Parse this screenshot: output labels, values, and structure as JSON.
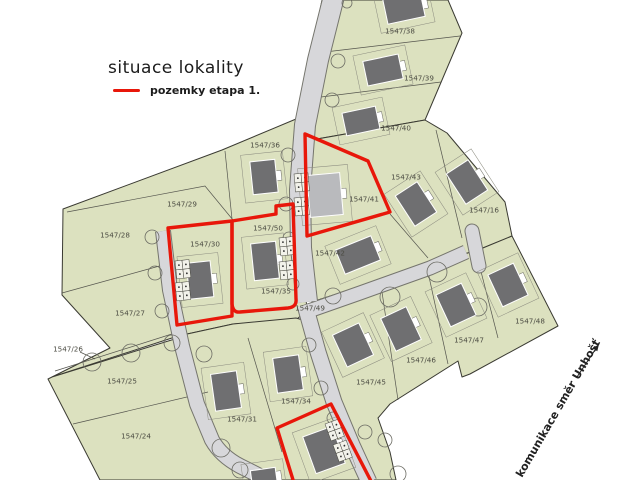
{
  "title": "situace lokality",
  "legend": {
    "label": "pozemky etapa 1.",
    "swatch_color": "#e8170a"
  },
  "road_direction": {
    "label": "komunikace směr Unhošť"
  },
  "colors": {
    "background": "#ffffff",
    "parcel": "#dce1bf",
    "outline": "#3a3a32",
    "inner_line": "#55554e",
    "road": "#d7d7da",
    "road_edge": "#75756d",
    "house": "#6f6f71",
    "house_light": "#b9babd",
    "envelope": "#8b8b7f",
    "tree": "#6c6c64",
    "red": "#e8170a",
    "label": "#4b4b42"
  },
  "map": {
    "blocks": [
      {
        "name": "west",
        "points": "63,209 222,150 296,119 300,150 301,245 307,310 296,320 233,324 178,336 52,377 110,348 62,295"
      },
      {
        "name": "southwest",
        "points": "52,377 178,338 190,395 205,435 222,458 240,470 254,480 100,480 48,379"
      },
      {
        "name": "south-middle",
        "points": "178,336 233,324 296,318 310,322 340,402 362,465 368,480 250,480 232,462 205,430 190,390"
      },
      {
        "name": "north-strip",
        "points": "322,0 448,0 462,33 425,120 300,142 304,95 313,45"
      },
      {
        "name": "east-middle",
        "points": "300,142 425,120 447,133 505,202 512,236 478,250 430,264 312,302 303,250 300,190"
      },
      {
        "name": "southeast",
        "points": "312,302 430,264 478,250 512,236 558,326 470,374 462,377 458,361 390,404 378,418 390,452 396,480 368,480 352,440 335,395 318,330"
      }
    ],
    "roads": [
      {
        "name": "road-north",
        "d": "M334,-4 L318,60 L305,125 L300,190 L301,248 L307,302",
        "width": 20
      },
      {
        "name": "road-east",
        "d": "M303,313 L360,293 L430,268 L466,252",
        "width": 13
      },
      {
        "name": "road-turnaround",
        "d": "M472,231 L479,266",
        "width": 13
      },
      {
        "name": "road-south",
        "d": "M305,305 L318,352 L334,402 L352,445 L369,482",
        "width": 15
      },
      {
        "name": "road-west",
        "d": "M163,231 L170,290 L182,346 L197,404 L212,440 Q221,456 240,466 L260,476",
        "width": 14
      }
    ],
    "boundaries": [
      {
        "points": "67,212 205,186 233,220"
      },
      {
        "points": "62,293 163,265"
      },
      {
        "points": "225,151 232,219"
      },
      {
        "points": "325,52 460,36"
      },
      {
        "points": "313,98 441,82"
      },
      {
        "points": "436,130 462,238"
      },
      {
        "points": "390,214 428,258"
      },
      {
        "points": "382,292 398,400"
      },
      {
        "points": "428,272 448,364"
      },
      {
        "points": "476,252 498,338"
      },
      {
        "points": "248,338 282,452"
      },
      {
        "points": "73,424 208,392"
      },
      {
        "points": "55,371 175,333"
      },
      {
        "points": "80,352 95,359"
      }
    ],
    "red_outlines": [
      {
        "name": "etapa1-parcel-41",
        "d": "M305,134 L368,161 L390,212 L307,236 Z"
      },
      {
        "name": "etapa1-parcel-30",
        "d": "M168,228 L232,221 L232,316 L177,325 Z"
      },
      {
        "name": "etapa1-parcel-50-35",
        "d": "M232,221 L276,214 L276,206 L293,204 L296,299 Q297,307 288,308 L240,312 Q233,313 232,304 Z"
      },
      {
        "name": "etapa1-parcel-south",
        "d": "M294,483 L277,428 L331,404 L372,483"
      }
    ],
    "houses": [
      {
        "cx": 404,
        "cy": 8,
        "w": 38,
        "h": 25,
        "rot": -12,
        "shade": "dark"
      },
      {
        "cx": 383,
        "cy": 70,
        "w": 36,
        "h": 25,
        "rot": -12,
        "shade": "dark"
      },
      {
        "cx": 361,
        "cy": 121,
        "w": 34,
        "h": 23,
        "rot": -12,
        "shade": "dark"
      },
      {
        "cx": 264,
        "cy": 177,
        "w": 25,
        "h": 33,
        "rot": -6,
        "shade": "dark"
      },
      {
        "cx": 325,
        "cy": 195,
        "w": 33,
        "h": 42,
        "rot": -5,
        "shade": "light"
      },
      {
        "cx": 416,
        "cy": 204,
        "w": 26,
        "h": 36,
        "rot": -33,
        "shade": "dark"
      },
      {
        "cx": 467,
        "cy": 182,
        "w": 26,
        "h": 36,
        "rot": -33,
        "shade": "dark"
      },
      {
        "cx": 358,
        "cy": 255,
        "w": 38,
        "h": 26,
        "rot": -22,
        "shade": "dark"
      },
      {
        "cx": 200,
        "cy": 280,
        "w": 24,
        "h": 36,
        "rot": -6,
        "shade": "dark"
      },
      {
        "cx": 265,
        "cy": 261,
        "w": 25,
        "h": 37,
        "rot": -6,
        "shade": "dark"
      },
      {
        "cx": 226,
        "cy": 391,
        "w": 26,
        "h": 37,
        "rot": -8,
        "shade": "dark"
      },
      {
        "cx": 288,
        "cy": 374,
        "w": 26,
        "h": 35,
        "rot": -8,
        "shade": "dark"
      },
      {
        "cx": 353,
        "cy": 345,
        "w": 29,
        "h": 35,
        "rot": -25,
        "shade": "dark"
      },
      {
        "cx": 401,
        "cy": 329,
        "w": 28,
        "h": 36,
        "rot": -25,
        "shade": "dark"
      },
      {
        "cx": 456,
        "cy": 305,
        "w": 28,
        "h": 35,
        "rot": -25,
        "shade": "dark"
      },
      {
        "cx": 508,
        "cy": 285,
        "w": 28,
        "h": 35,
        "rot": -25,
        "shade": "dark"
      },
      {
        "cx": 324,
        "cy": 450,
        "w": 31,
        "h": 39,
        "rot": -20,
        "shade": "dark"
      },
      {
        "cx": 264,
        "cy": 478,
        "w": 25,
        "h": 18,
        "rot": -8,
        "shade": "dark"
      }
    ],
    "garages": [
      {
        "x": 294,
        "y": 174,
        "rot": -5
      },
      {
        "x": 294,
        "y": 198,
        "rot": -5
      },
      {
        "x": 175,
        "y": 261,
        "rot": -6
      },
      {
        "x": 175,
        "y": 283,
        "rot": -6
      },
      {
        "x": 279,
        "y": 238,
        "rot": -6
      },
      {
        "x": 279,
        "y": 262,
        "rot": -6
      },
      {
        "x": 325,
        "y": 424,
        "rot": -20
      },
      {
        "x": 333,
        "y": 445,
        "rot": -20
      }
    ],
    "trees": [
      {
        "cx": 152,
        "cy": 237,
        "r": 7
      },
      {
        "cx": 155,
        "cy": 273,
        "r": 7
      },
      {
        "cx": 162,
        "cy": 311,
        "r": 7
      },
      {
        "cx": 92,
        "cy": 362,
        "r": 9
      },
      {
        "cx": 131,
        "cy": 353,
        "r": 9
      },
      {
        "cx": 172,
        "cy": 343,
        "r": 8
      },
      {
        "cx": 204,
        "cy": 354,
        "r": 8
      },
      {
        "cx": 221,
        "cy": 448,
        "r": 9
      },
      {
        "cx": 240,
        "cy": 470,
        "r": 8
      },
      {
        "cx": 288,
        "cy": 155,
        "r": 7
      },
      {
        "cx": 286,
        "cy": 204,
        "r": 7
      },
      {
        "cx": 289,
        "cy": 238,
        "r": 6
      },
      {
        "cx": 293,
        "cy": 284,
        "r": 6
      },
      {
        "cx": 338,
        "cy": 61,
        "r": 7
      },
      {
        "cx": 332,
        "cy": 100,
        "r": 7
      },
      {
        "cx": 347,
        "cy": 3,
        "r": 5
      },
      {
        "cx": 333,
        "cy": 296,
        "r": 8
      },
      {
        "cx": 390,
        "cy": 297,
        "r": 10
      },
      {
        "cx": 437,
        "cy": 272,
        "r": 10
      },
      {
        "cx": 478,
        "cy": 307,
        "r": 9
      },
      {
        "cx": 309,
        "cy": 345,
        "r": 7
      },
      {
        "cx": 321,
        "cy": 388,
        "r": 7
      },
      {
        "cx": 333,
        "cy": 418,
        "r": 6
      },
      {
        "cx": 365,
        "cy": 432,
        "r": 7
      },
      {
        "cx": 385,
        "cy": 440,
        "r": 7
      },
      {
        "cx": 398,
        "cy": 474,
        "r": 8
      }
    ],
    "parcels": [
      {
        "label": "1547/38",
        "x": 400,
        "y": 31
      },
      {
        "label": "1547/39",
        "x": 419,
        "y": 78
      },
      {
        "label": "1547/40",
        "x": 396,
        "y": 128
      },
      {
        "label": "1547/36",
        "x": 265,
        "y": 145
      },
      {
        "label": "1547/43",
        "x": 406,
        "y": 177
      },
      {
        "label": "1547/41",
        "x": 364,
        "y": 199
      },
      {
        "label": "1547/16",
        "x": 484,
        "y": 210
      },
      {
        "label": "1547/29",
        "x": 182,
        "y": 204
      },
      {
        "label": "1547/28",
        "x": 115,
        "y": 235
      },
      {
        "label": "1547/30",
        "x": 205,
        "y": 244
      },
      {
        "label": "1547/50",
        "x": 268,
        "y": 228
      },
      {
        "label": "1547/42",
        "x": 330,
        "y": 253
      },
      {
        "label": "1547/35",
        "x": 276,
        "y": 291
      },
      {
        "label": "1547/49",
        "x": 310,
        "y": 308
      },
      {
        "label": "1547/27",
        "x": 130,
        "y": 313
      },
      {
        "label": "1547/26",
        "x": 68,
        "y": 349
      },
      {
        "label": "1547/25",
        "x": 122,
        "y": 381
      },
      {
        "label": "1547/24",
        "x": 136,
        "y": 436
      },
      {
        "label": "1547/31",
        "x": 242,
        "y": 419
      },
      {
        "label": "1547/34",
        "x": 296,
        "y": 401
      },
      {
        "label": "1547/45",
        "x": 371,
        "y": 382
      },
      {
        "label": "1547/46",
        "x": 421,
        "y": 360
      },
      {
        "label": "1547/47",
        "x": 469,
        "y": 340
      },
      {
        "label": "1547/48",
        "x": 530,
        "y": 321
      }
    ],
    "arrow": {
      "x1": 577,
      "y1": 377,
      "x2": 599,
      "y2": 344
    }
  }
}
